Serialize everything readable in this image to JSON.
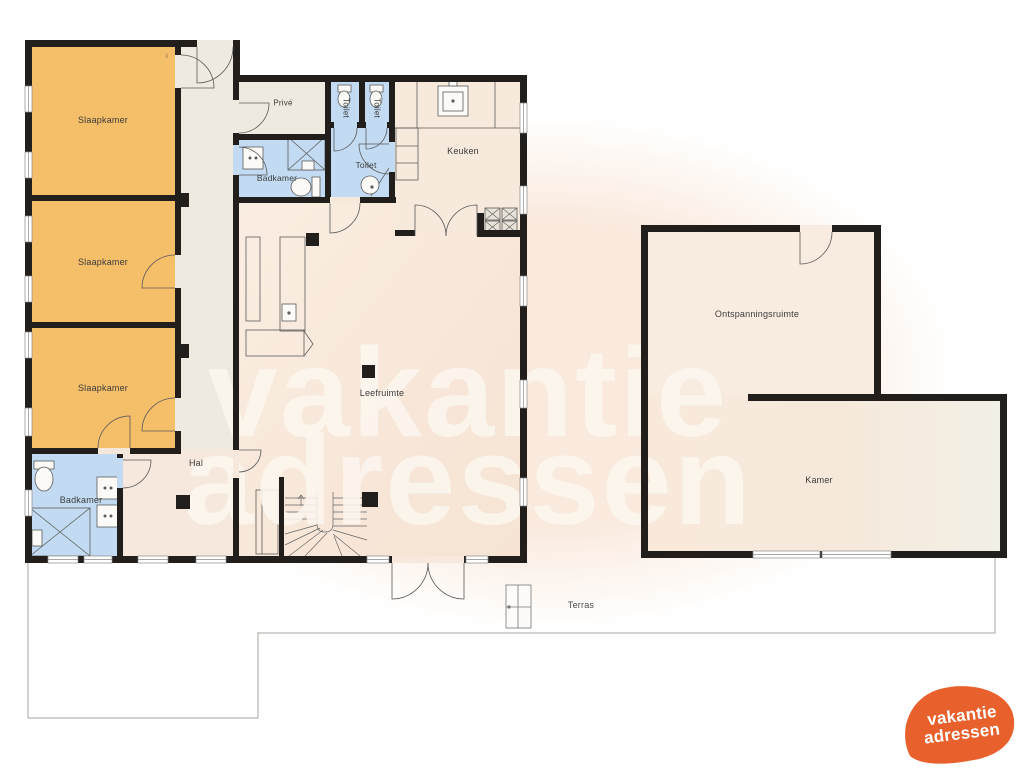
{
  "rooms": {
    "slaapkamer_1": "Slaapkamer",
    "slaapkamer_2": "Slaapkamer",
    "slaapkamer_3": "Slaapkamer",
    "prive": "Privé",
    "toilet_small_1": "Toilet",
    "toilet_small_2": "Toilet",
    "badkamer_top": "Badkamer",
    "toilet_room": "Toilet",
    "keuken": "Keuken",
    "leefruimte": "Leefruimte",
    "hal": "Hal",
    "badkamer_bottom": "Badkamer",
    "ontspanningsruimte": "Ontspanningsruimte",
    "kamer": "Kamer",
    "terras": "Terras"
  },
  "annotation": "i",
  "watermark": {
    "line1": "vakantie",
    "line2": "adressen"
  },
  "logo": {
    "line1": "vakantie",
    "line2": "adressen"
  },
  "colors": {
    "bedroom_orange": "#F5BE69",
    "bathroom_blue": "#C2DBF2",
    "hallway_cream": "#EFEADF",
    "living_pink": "#F8E9DC",
    "wall_black": "#211E1B",
    "logo_orange": "#E8612C",
    "watermark_cream": "#FBF2E9"
  }
}
